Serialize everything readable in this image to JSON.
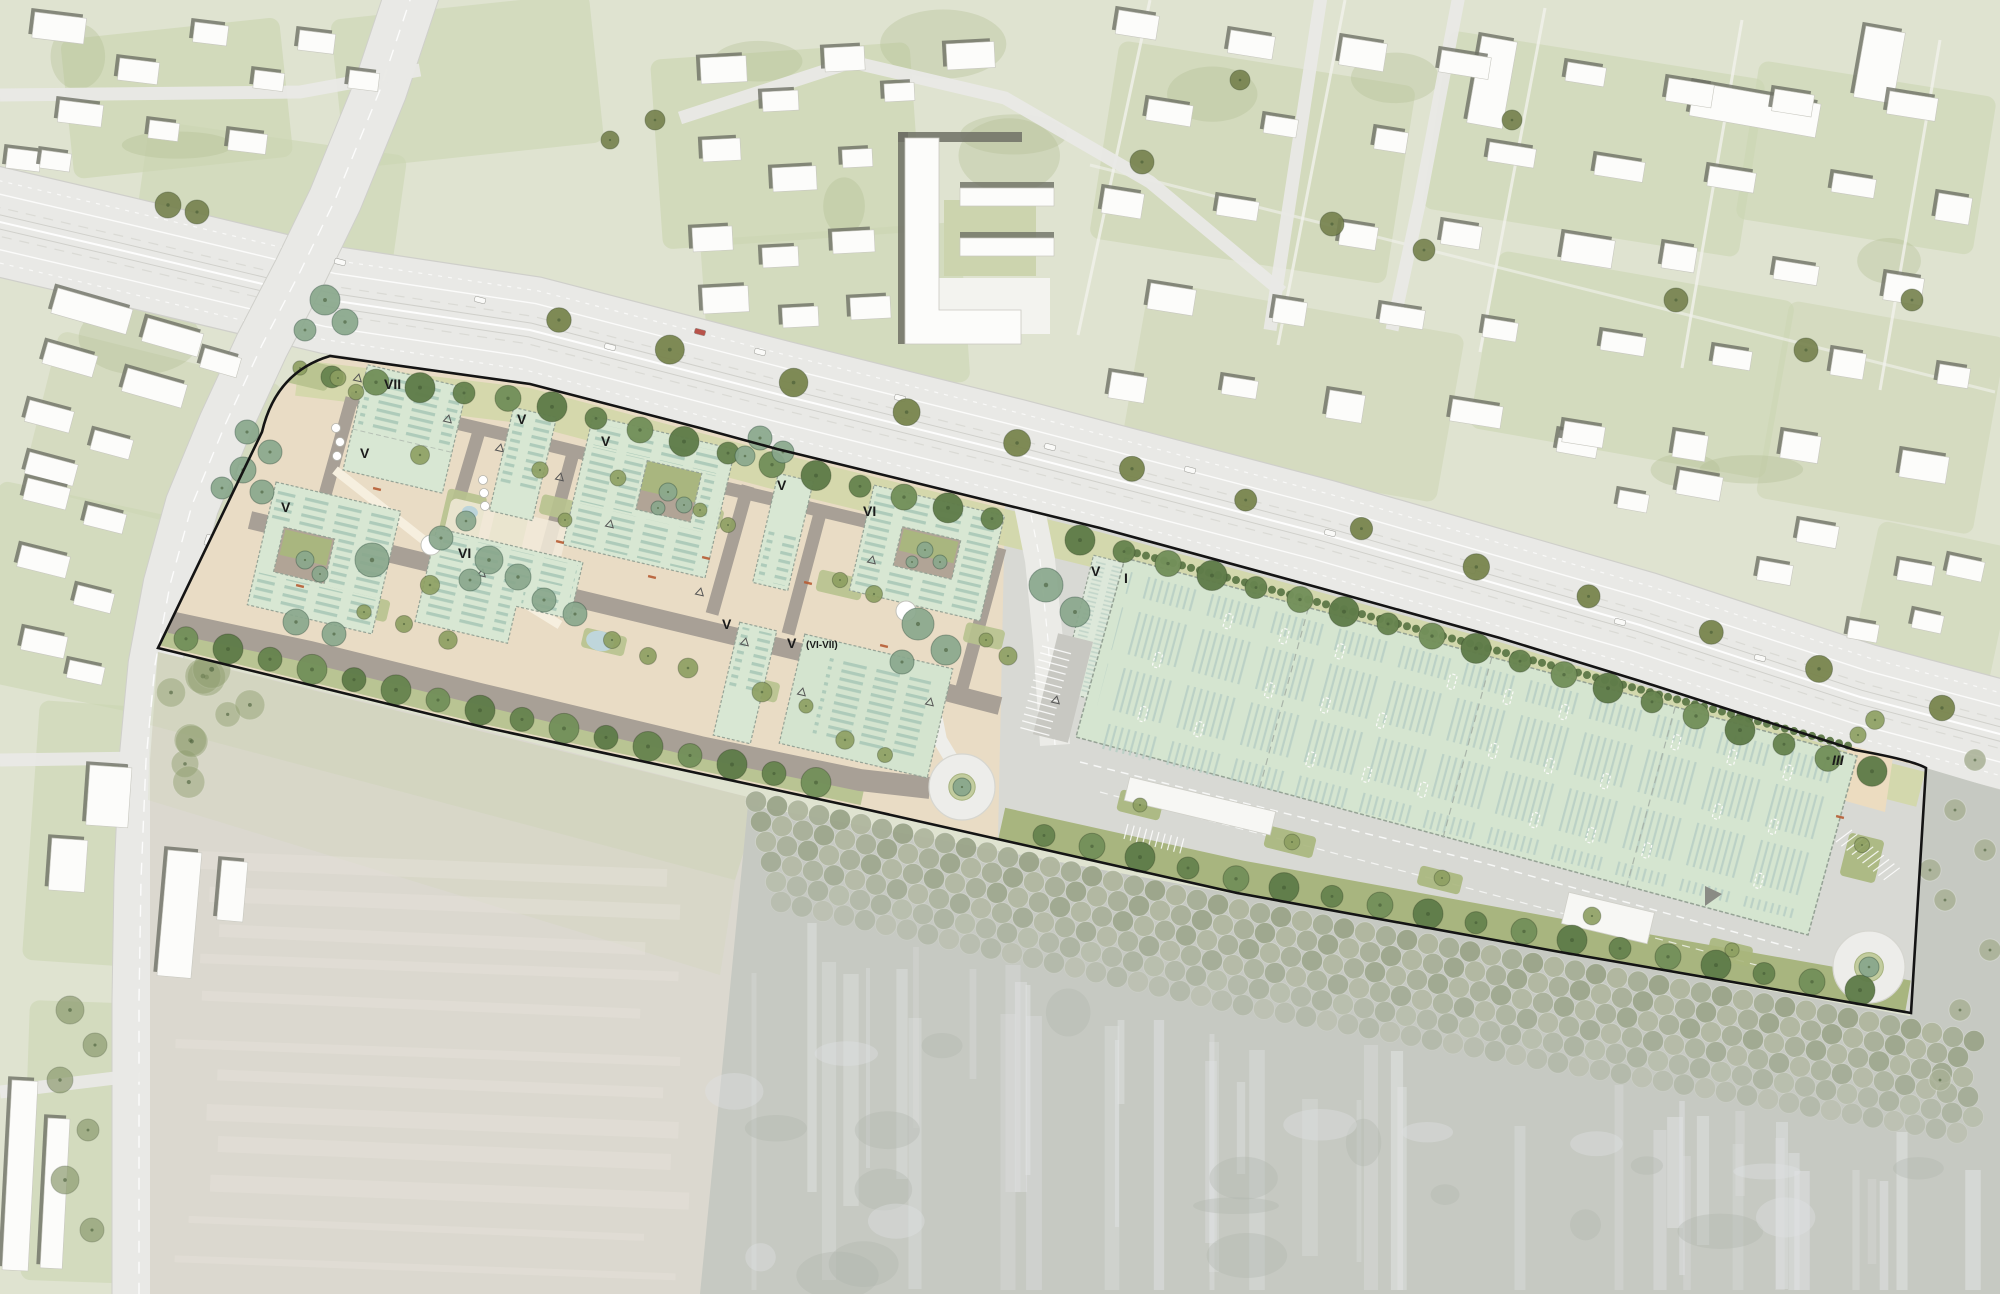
{
  "plan": {
    "type": "architectural-site-plan",
    "building_labels": [
      {
        "text": "VII",
        "x": 384,
        "y": 389
      },
      {
        "text": "V",
        "x": 360,
        "y": 458
      },
      {
        "text": "V",
        "x": 281,
        "y": 512
      },
      {
        "text": "V",
        "x": 517,
        "y": 424
      },
      {
        "text": "V",
        "x": 601,
        "y": 446
      },
      {
        "text": "VI",
        "x": 458,
        "y": 558
      },
      {
        "text": "V",
        "x": 777,
        "y": 490
      },
      {
        "text": "VI",
        "x": 863,
        "y": 516
      },
      {
        "text": "V",
        "x": 722,
        "y": 629
      },
      {
        "text": "V",
        "x": 787,
        "y": 648
      },
      {
        "text": "(VI-VII)",
        "x": 806,
        "y": 648,
        "small": true
      },
      {
        "text": "V",
        "x": 1091,
        "y": 576
      },
      {
        "text": "I",
        "x": 1124,
        "y": 583
      },
      {
        "text": "III",
        "x": 1832,
        "y": 765,
        "italic": true
      }
    ],
    "palette": {
      "context_green": "#dfe3d0",
      "parcel_green": "#ccd5b2",
      "road_grey": "#e9e9e6",
      "building_white": "#fcfcfa",
      "building_shadow": "#6e7065",
      "field_grey": "#dbd8cf",
      "forest_grey": "#c6c9c2",
      "forest_tree": "#a6ae96",
      "site_beige": "#e9dcc5",
      "site_street": "#a8a096",
      "apron_grey": "#d8d9d4",
      "roof_green": "#d8e7d3",
      "hall_roof": "#d5e5d0",
      "verge_green": "#b6c290",
      "hedge_green": "#5d7847",
      "tree_dark": "#6d8a55",
      "tree_teal": "#8aa88d",
      "tree_olive": "#8d9f61",
      "water": "#b9d3da",
      "accent_red": "#b65c33",
      "loop_white": "#ededea",
      "boundary": "#141414",
      "label": "#1b1b1b"
    }
  }
}
